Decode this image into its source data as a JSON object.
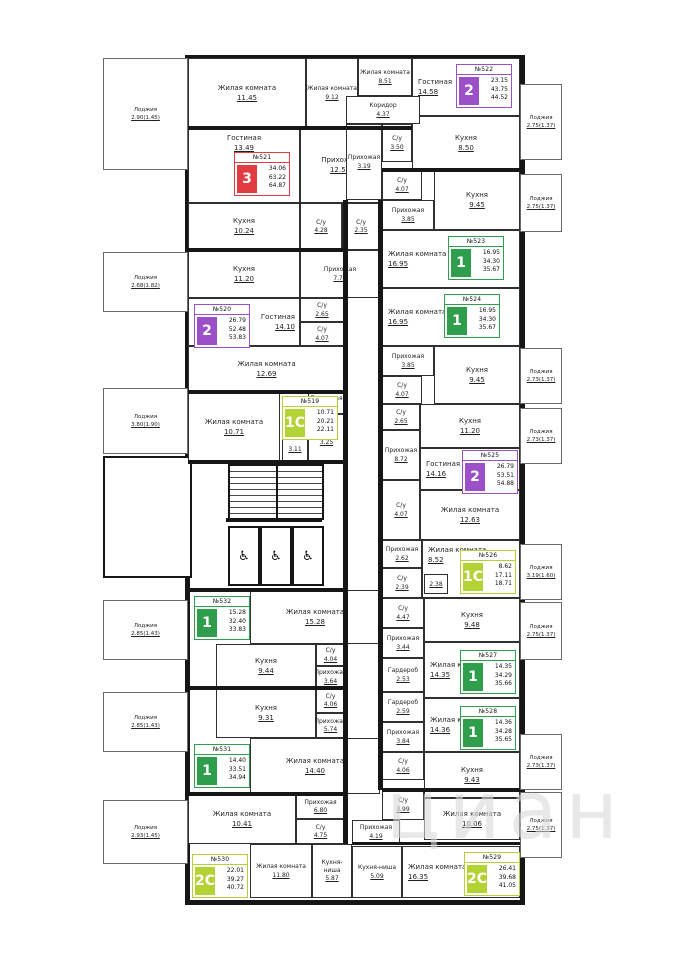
{
  "watermark": {
    "text": "циан"
  },
  "palette": {
    "red": "#E03C41",
    "purple": "#9B50C8",
    "green": "#2E9E4C",
    "lime": "#B2D235",
    "wall": "#161616"
  },
  "elevators": {
    "count": 3,
    "glyph": "♿",
    "name": "wheelchair-icon"
  },
  "apartments": [
    {
      "num": "№521",
      "label": "3",
      "color": "red",
      "areas": [
        "34.06",
        "63.22",
        "64.87"
      ],
      "badge": [
        234,
        152
      ]
    },
    {
      "num": "№522",
      "label": "2",
      "color": "purple",
      "areas": [
        "23.15",
        "43.75",
        "44.52"
      ],
      "badge": [
        456,
        64
      ]
    },
    {
      "num": "№523",
      "label": "1",
      "color": "green",
      "areas": [
        "16.95",
        "34.30",
        "35.67"
      ],
      "badge": [
        448,
        236
      ]
    },
    {
      "num": "№524",
      "label": "1",
      "color": "green",
      "areas": [
        "16.95",
        "34.30",
        "35.67"
      ],
      "badge": [
        444,
        294
      ]
    },
    {
      "num": "№525",
      "label": "2",
      "color": "purple",
      "areas": [
        "26.79",
        "53.51",
        "54.88"
      ],
      "badge": [
        462,
        450
      ]
    },
    {
      "num": "№526",
      "label": "1С",
      "color": "lime",
      "areas": [
        "8.62",
        "17.11",
        "18.71"
      ],
      "badge": [
        460,
        550
      ]
    },
    {
      "num": "№527",
      "label": "1",
      "color": "green",
      "areas": [
        "14.35",
        "34.29",
        "35.66"
      ],
      "badge": [
        460,
        650
      ]
    },
    {
      "num": "№528",
      "label": "1",
      "color": "green",
      "areas": [
        "14.36",
        "34.28",
        "35.65"
      ],
      "badge": [
        460,
        706
      ]
    },
    {
      "num": "№529",
      "label": "2С",
      "color": "lime",
      "areas": [
        "26.41",
        "39.68",
        "41.05"
      ],
      "badge": [
        464,
        852
      ]
    },
    {
      "num": "№530",
      "label": "2С",
      "color": "lime",
      "areas": [
        "22.01",
        "39.27",
        "40.72"
      ],
      "badge": [
        192,
        854
      ]
    },
    {
      "num": "№531",
      "label": "1",
      "color": "green",
      "areas": [
        "14.40",
        "33.51",
        "34.94"
      ],
      "badge": [
        194,
        744
      ]
    },
    {
      "num": "№532",
      "label": "1",
      "color": "green",
      "areas": [
        "15.28",
        "32.40",
        "33.83"
      ],
      "badge": [
        194,
        596
      ]
    },
    {
      "num": "№519",
      "label": "1С",
      "color": "lime",
      "areas": [
        "10.71",
        "20.21",
        "22.11"
      ],
      "badge": [
        282,
        396
      ]
    },
    {
      "num": "№520",
      "label": "2",
      "color": "purple",
      "areas": [
        "26.79",
        "52.48",
        "53.83"
      ],
      "badge": [
        194,
        304
      ]
    }
  ],
  "rooms": [
    {
      "apt": "521",
      "n": "Жилая комната",
      "a": "11.45",
      "b": [
        188,
        58,
        118,
        70
      ],
      "c": ""
    },
    {
      "apt": "521",
      "n": "Жилая комната",
      "a": "9.12",
      "b": [
        306,
        58,
        52,
        70
      ],
      "c": "sm"
    },
    {
      "apt": "521",
      "n": "Гостиная",
      "a": "13.49",
      "b": [
        188,
        128,
        112,
        75
      ],
      "c": "lt"
    },
    {
      "apt": "521",
      "n": "Кухня",
      "a": "10.24",
      "b": [
        188,
        203,
        112,
        47
      ],
      "c": ""
    },
    {
      "apt": "521",
      "n": "Прихожая",
      "a": "12.50",
      "b": [
        300,
        128,
        80,
        75
      ],
      "c": ""
    },
    {
      "apt": "521",
      "n": "С/у",
      "a": "4.28",
      "b": [
        300,
        203,
        42,
        47
      ],
      "c": "sm"
    },
    {
      "apt": "521",
      "n": "С/у",
      "a": "2.35",
      "b": [
        342,
        203,
        38,
        47
      ],
      "c": "sm"
    },
    {
      "apt": "521",
      "n": "Лоджия",
      "a": "2.90(1.45)",
      "b": [
        103,
        58,
        85,
        112
      ],
      "c": "lg"
    },
    {
      "apt": "522",
      "n": "Жилая комната",
      "a": "8.51",
      "b": [
        358,
        58,
        54,
        38
      ],
      "c": "sm"
    },
    {
      "apt": "522",
      "n": "Гостиная",
      "a": "14.58",
      "b": [
        412,
        58,
        108,
        58
      ],
      "c": "ll"
    },
    {
      "apt": "522",
      "n": "Кухня",
      "a": "8.50",
      "b": [
        412,
        116,
        108,
        54
      ],
      "c": ""
    },
    {
      "apt": "522",
      "n": "Коридор",
      "a": "4.37",
      "b": [
        346,
        96,
        74,
        28
      ],
      "c": "sm"
    },
    {
      "apt": "522",
      "n": "Прихожая",
      "a": "3.19",
      "b": [
        346,
        124,
        36,
        76
      ],
      "c": "sm"
    },
    {
      "apt": "522",
      "n": "С/у",
      "a": "3.50",
      "b": [
        382,
        124,
        30,
        38
      ],
      "c": "sm"
    },
    {
      "apt": "522",
      "n": "Лоджия",
      "a": "2.75(1.37)",
      "b": [
        520,
        84,
        42,
        76
      ],
      "c": "lg"
    },
    {
      "apt": "523",
      "n": "С/у",
      "a": "4.07",
      "b": [
        382,
        170,
        40,
        30
      ],
      "c": "sm"
    },
    {
      "apt": "523",
      "n": "Прихожая",
      "a": "3.85",
      "b": [
        382,
        200,
        52,
        30
      ],
      "c": "sm"
    },
    {
      "apt": "523",
      "n": "Кухня",
      "a": "9.45",
      "b": [
        434,
        170,
        86,
        60
      ],
      "c": ""
    },
    {
      "apt": "523",
      "n": "Жилая комната",
      "a": "16.95",
      "b": [
        382,
        230,
        138,
        58
      ],
      "c": "ll"
    },
    {
      "apt": "523",
      "n": "Лоджия",
      "a": "2.75(1.37)",
      "b": [
        520,
        174,
        42,
        58
      ],
      "c": "lg"
    },
    {
      "apt": "524",
      "n": "Жилая комната",
      "a": "16.95",
      "b": [
        382,
        288,
        138,
        58
      ],
      "c": "ll"
    },
    {
      "apt": "524",
      "n": "Прихожая",
      "a": "3.85",
      "b": [
        382,
        346,
        52,
        30
      ],
      "c": "sm"
    },
    {
      "apt": "524",
      "n": "С/у",
      "a": "4.07",
      "b": [
        382,
        376,
        40,
        28
      ],
      "c": "sm"
    },
    {
      "apt": "524",
      "n": "Кухня",
      "a": "9.45",
      "b": [
        434,
        346,
        86,
        58
      ],
      "c": ""
    },
    {
      "apt": "524",
      "n": "Лоджия",
      "a": "2.73(1.37)",
      "b": [
        520,
        348,
        42,
        56
      ],
      "c": "lg"
    },
    {
      "apt": "525",
      "n": "С/у",
      "a": "2.65",
      "b": [
        382,
        404,
        38,
        26
      ],
      "c": "sm"
    },
    {
      "apt": "525",
      "n": "Прихожая",
      "a": "8.72",
      "b": [
        382,
        430,
        38,
        50
      ],
      "c": "sm"
    },
    {
      "apt": "525",
      "n": "Кухня",
      "a": "11.20",
      "b": [
        420,
        404,
        100,
        44
      ],
      "c": ""
    },
    {
      "apt": "525",
      "n": "Гостиная",
      "a": "14.16",
      "b": [
        420,
        448,
        100,
        42
      ],
      "c": "ll"
    },
    {
      "apt": "525",
      "n": "С/у",
      "a": "4.07",
      "b": [
        382,
        480,
        38,
        60
      ],
      "c": "sm"
    },
    {
      "apt": "525",
      "n": "Жилая комната",
      "a": "12.63",
      "b": [
        420,
        490,
        100,
        50
      ],
      "c": ""
    },
    {
      "apt": "525",
      "n": "Лоджия",
      "a": "2.73(1.37)",
      "b": [
        520,
        408,
        42,
        56
      ],
      "c": "lg"
    },
    {
      "apt": "526",
      "n": "Прихожая",
      "a": "2.62",
      "b": [
        382,
        540,
        40,
        28
      ],
      "c": "sm"
    },
    {
      "apt": "526",
      "n": "С/у",
      "a": "2.39",
      "b": [
        382,
        568,
        40,
        30
      ],
      "c": "sm"
    },
    {
      "apt": "526",
      "n": "Жилая комната",
      "a": "8.52",
      "b": [
        422,
        540,
        98,
        58
      ],
      "c": "ll lt"
    },
    {
      "apt": "526",
      "n": "",
      "a": "2.38",
      "b": [
        424,
        574,
        24,
        20
      ],
      "c": "sm"
    },
    {
      "apt": "526",
      "n": "Лоджия",
      "a": "3.19(1.60)",
      "b": [
        520,
        544,
        42,
        56
      ],
      "c": "lg"
    },
    {
      "apt": "527",
      "n": "С/у",
      "a": "4.47",
      "b": [
        382,
        598,
        42,
        30
      ],
      "c": "sm"
    },
    {
      "apt": "527",
      "n": "Кухня",
      "a": "9.48",
      "b": [
        424,
        598,
        96,
        44
      ],
      "c": ""
    },
    {
      "apt": "527",
      "n": "Прихожая",
      "a": "3.44",
      "b": [
        382,
        628,
        42,
        30
      ],
      "c": "sm"
    },
    {
      "apt": "527",
      "n": "Гардероб",
      "a": "2.53",
      "b": [
        382,
        658,
        42,
        34
      ],
      "c": "sm"
    },
    {
      "apt": "527",
      "n": "Жилая комната",
      "a": "14.35",
      "b": [
        424,
        642,
        96,
        56
      ],
      "c": "ll"
    },
    {
      "apt": "527",
      "n": "Лоджия",
      "a": "2.75(1.37)",
      "b": [
        520,
        602,
        42,
        58
      ],
      "c": "lg"
    },
    {
      "apt": "528",
      "n": "Гардероб",
      "a": "2.59",
      "b": [
        382,
        692,
        42,
        30
      ],
      "c": "sm"
    },
    {
      "apt": "528",
      "n": "Жилая комната",
      "a": "14.36",
      "b": [
        424,
        698,
        96,
        54
      ],
      "c": "ll"
    },
    {
      "apt": "528",
      "n": "Прихожая",
      "a": "3.84",
      "b": [
        382,
        722,
        42,
        30
      ],
      "c": "sm"
    },
    {
      "apt": "528",
      "n": "С/у",
      "a": "4.06",
      "b": [
        382,
        752,
        42,
        28
      ],
      "c": "sm"
    },
    {
      "apt": "528",
      "n": "Кухня",
      "a": "9.43",
      "b": [
        424,
        752,
        96,
        46
      ],
      "c": ""
    },
    {
      "apt": "528",
      "n": "Лоджия",
      "a": "2.73(1.37)",
      "b": [
        520,
        734,
        42,
        56
      ],
      "c": "lg"
    },
    {
      "apt": "529",
      "n": "С/у",
      "a": "3.99",
      "b": [
        382,
        790,
        42,
        30
      ],
      "c": "sm"
    },
    {
      "apt": "529",
      "n": "Жилая комната",
      "a": "10.06",
      "b": [
        424,
        798,
        96,
        42
      ],
      "c": ""
    },
    {
      "apt": "529",
      "n": "Прихожая",
      "a": "4.19",
      "b": [
        352,
        820,
        48,
        24
      ],
      "c": "sm"
    },
    {
      "apt": "529",
      "n": "Кухня-ниша",
      "a": "5.09",
      "b": [
        352,
        846,
        50,
        52
      ],
      "c": "sm"
    },
    {
      "apt": "529",
      "n": "Жилая комната",
      "a": "16.35",
      "b": [
        402,
        846,
        118,
        52
      ],
      "c": "ll"
    },
    {
      "apt": "529",
      "n": "Лоджия",
      "a": "2.75(1.37)",
      "b": [
        520,
        792,
        42,
        66
      ],
      "c": "lg"
    },
    {
      "apt": "530",
      "n": "Жилая комната",
      "a": "10.41",
      "b": [
        188,
        794,
        108,
        50
      ],
      "c": ""
    },
    {
      "apt": "530",
      "n": "Прихожая",
      "a": "6.80",
      "b": [
        296,
        794,
        49,
        25
      ],
      "c": "sm"
    },
    {
      "apt": "530",
      "n": "С/у",
      "a": "4.75",
      "b": [
        296,
        819,
        49,
        25
      ],
      "c": "sm"
    },
    {
      "apt": "530",
      "n": "Жилая комната",
      "a": "11.80",
      "b": [
        250,
        844,
        62,
        54
      ],
      "c": "sm"
    },
    {
      "apt": "530",
      "n": "Кухня-ниша",
      "a": "5.87",
      "b": [
        312,
        844,
        40,
        54
      ],
      "c": "sm"
    },
    {
      "apt": "530",
      "n": "Лоджия",
      "a": "2.93(1.45)",
      "b": [
        103,
        800,
        85,
        64
      ],
      "c": "lg"
    },
    {
      "apt": "531",
      "n": "Кухня",
      "a": "9.31",
      "b": [
        216,
        688,
        100,
        50
      ],
      "c": ""
    },
    {
      "apt": "531",
      "n": "С/у",
      "a": "4.06",
      "b": [
        316,
        688,
        29,
        25
      ],
      "c": "sm"
    },
    {
      "apt": "531",
      "n": "Прихожая",
      "a": "5.74",
      "b": [
        316,
        713,
        29,
        25
      ],
      "c": "sm"
    },
    {
      "apt": "531",
      "n": "Жилая комната",
      "a": "14.40",
      "b": [
        250,
        738,
        130,
        56
      ],
      "c": ""
    },
    {
      "apt": "531",
      "n": "Лоджия",
      "a": "2.85(1.43)",
      "b": [
        103,
        692,
        85,
        60
      ],
      "c": "lg"
    },
    {
      "apt": "532",
      "n": "Жилая комната",
      "a": "15.28",
      "b": [
        250,
        590,
        130,
        54
      ],
      "c": ""
    },
    {
      "apt": "532",
      "n": "Кухня",
      "a": "9.44",
      "b": [
        216,
        644,
        100,
        44
      ],
      "c": ""
    },
    {
      "apt": "532",
      "n": "С/у",
      "a": "4.04",
      "b": [
        316,
        644,
        29,
        22
      ],
      "c": "sm"
    },
    {
      "apt": "532",
      "n": "Прихожая",
      "a": "3.64",
      "b": [
        316,
        666,
        29,
        22
      ],
      "c": "sm"
    },
    {
      "apt": "532",
      "n": "Лоджия",
      "a": "2.85(1.43)",
      "b": [
        103,
        600,
        85,
        60
      ],
      "c": "lg"
    },
    {
      "apt": "519",
      "n": "Жилая комната",
      "a": "10.71",
      "b": [
        188,
        392,
        92,
        70
      ],
      "c": ""
    },
    {
      "apt": "519",
      "n": "Прихожая",
      "a": "3.16",
      "b": [
        308,
        392,
        37,
        22
      ],
      "c": "sm"
    },
    {
      "apt": "519",
      "n": "С/у",
      "a": "3.25",
      "b": [
        308,
        414,
        37,
        48
      ],
      "c": "sm"
    },
    {
      "apt": "519",
      "n": "",
      "a": "3.11",
      "b": [
        282,
        436,
        26,
        26
      ],
      "c": "sm"
    },
    {
      "apt": "519",
      "n": "Лоджия",
      "a": "3.80(1.90)",
      "b": [
        103,
        388,
        85,
        66
      ],
      "c": "lg"
    },
    {
      "apt": "520",
      "n": "Кухня",
      "a": "11.20",
      "b": [
        188,
        250,
        112,
        48
      ],
      "c": ""
    },
    {
      "apt": "520",
      "n": "Прихожая",
      "a": "7.77",
      "b": [
        300,
        250,
        80,
        48
      ],
      "c": "sm"
    },
    {
      "apt": "520",
      "n": "Гостиная",
      "a": "14.10",
      "b": [
        188,
        298,
        112,
        48
      ],
      "c": "lr"
    },
    {
      "apt": "520",
      "n": "С/у",
      "a": "2.65",
      "b": [
        300,
        298,
        44,
        24
      ],
      "c": "sm"
    },
    {
      "apt": "520",
      "n": "С/у",
      "a": "4.07",
      "b": [
        300,
        322,
        44,
        24
      ],
      "c": "sm"
    },
    {
      "apt": "520",
      "n": "Жилая комната",
      "a": "12.69",
      "b": [
        188,
        346,
        157,
        46
      ],
      "c": ""
    },
    {
      "apt": "520",
      "n": "Лоджия",
      "a": "2.68(1.82)",
      "b": [
        103,
        252,
        85,
        60
      ],
      "c": "lg"
    }
  ]
}
